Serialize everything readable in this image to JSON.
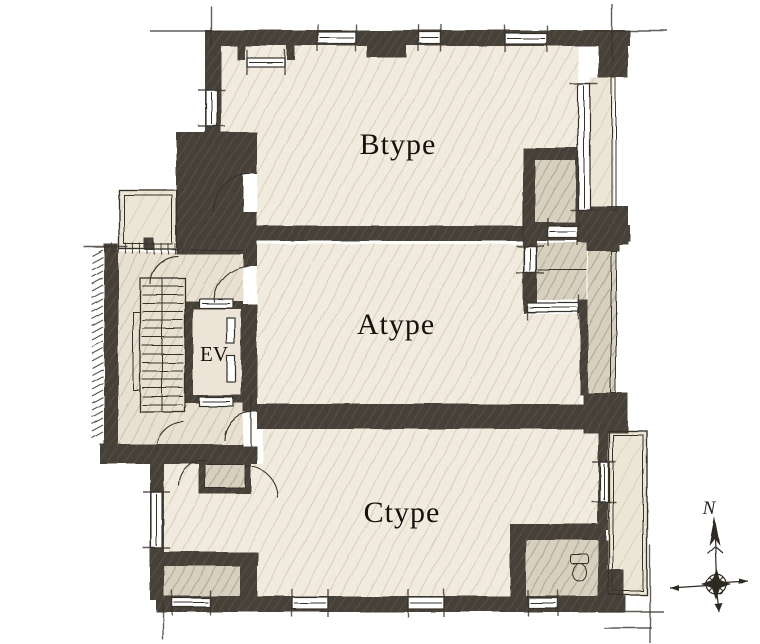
{
  "plan": {
    "title": "residential-floor-plan",
    "units": [
      {
        "id": "btype",
        "label": "Btype"
      },
      {
        "id": "atype",
        "label": "Atype"
      },
      {
        "id": "ctype",
        "label": "Ctype"
      }
    ],
    "elevator": {
      "label": "EV"
    },
    "compass": {
      "north_label": "N"
    }
  },
  "colors": {
    "paper": "#ffffff",
    "wall": "#453f37",
    "wall_streak": "#5d564c",
    "room": "#f1eade",
    "service": "#d8d0bf",
    "hall": "#e8e1d2",
    "balcony": "#ece6d7",
    "line": "#343029",
    "hatch": "#ab9f88"
  }
}
